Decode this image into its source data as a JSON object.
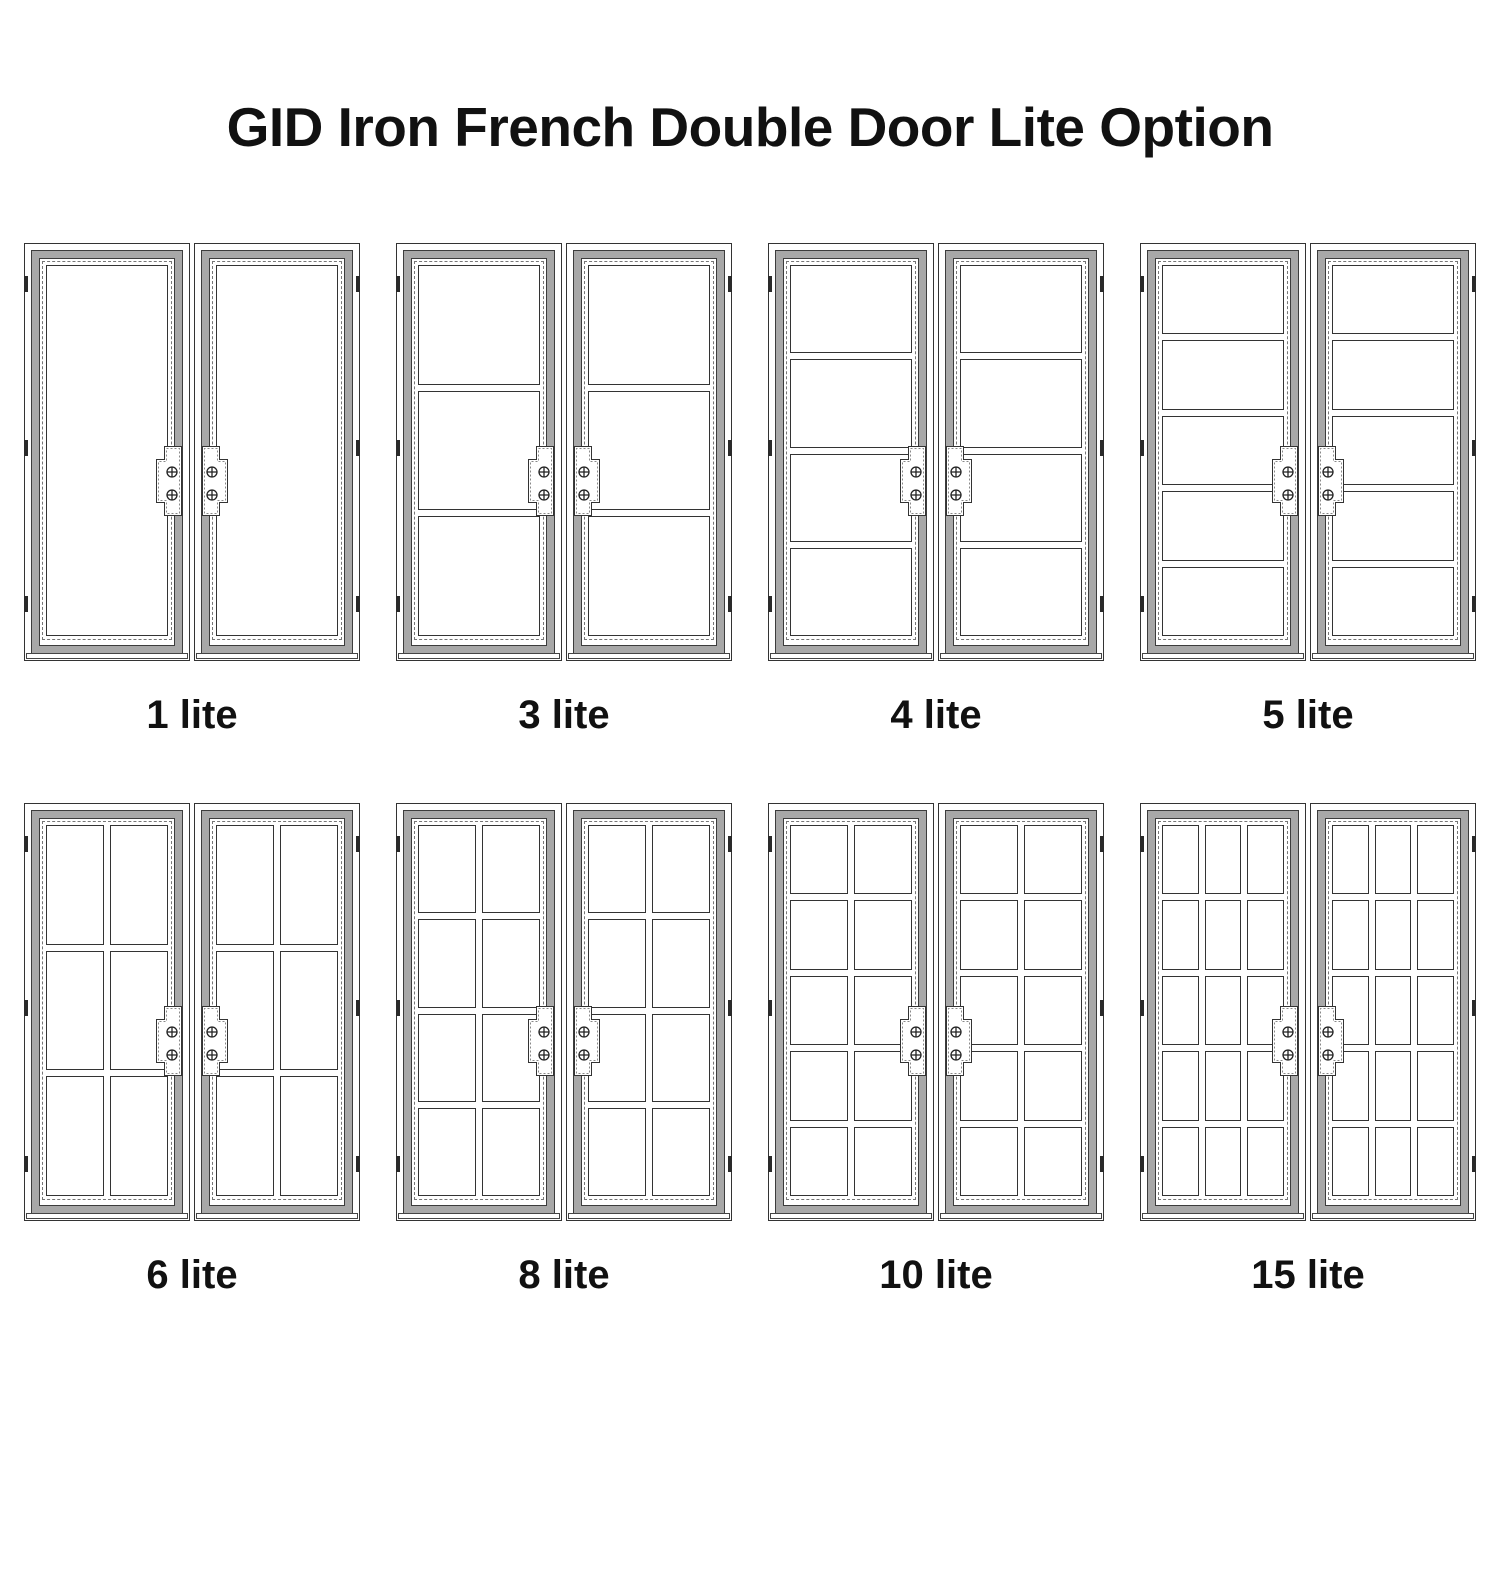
{
  "title": "GID Iron French Double Door Lite Option",
  "options": [
    {
      "id": "1-lite",
      "label": "1 lite",
      "lites": 1,
      "rows": 1,
      "cols": 1
    },
    {
      "id": "3-lite",
      "label": "3 lite",
      "lites": 3,
      "rows": 3,
      "cols": 1
    },
    {
      "id": "4-lite",
      "label": "4 lite",
      "lites": 4,
      "rows": 4,
      "cols": 1
    },
    {
      "id": "5-lite",
      "label": "5 lite",
      "lites": 5,
      "rows": 5,
      "cols": 1
    },
    {
      "id": "6-lite",
      "label": "6 lite",
      "lites": 6,
      "rows": 3,
      "cols": 2
    },
    {
      "id": "8-lite",
      "label": "8 lite",
      "lites": 8,
      "rows": 4,
      "cols": 2
    },
    {
      "id": "10-lite",
      "label": "10 lite",
      "lites": 10,
      "rows": 5,
      "cols": 2
    },
    {
      "id": "15-lite",
      "label": "15 lite",
      "lites": 15,
      "rows": 5,
      "cols": 3
    }
  ],
  "door": {
    "leaves_per_unit": 2,
    "hinges_per_leaf": 3,
    "handle_screws_per_leaf": 2
  },
  "colors": {
    "line": "#333333",
    "frame_fill": "#a8a8a8",
    "dashed_line": "#777777",
    "background": "#ffffff",
    "text": "#111111"
  }
}
